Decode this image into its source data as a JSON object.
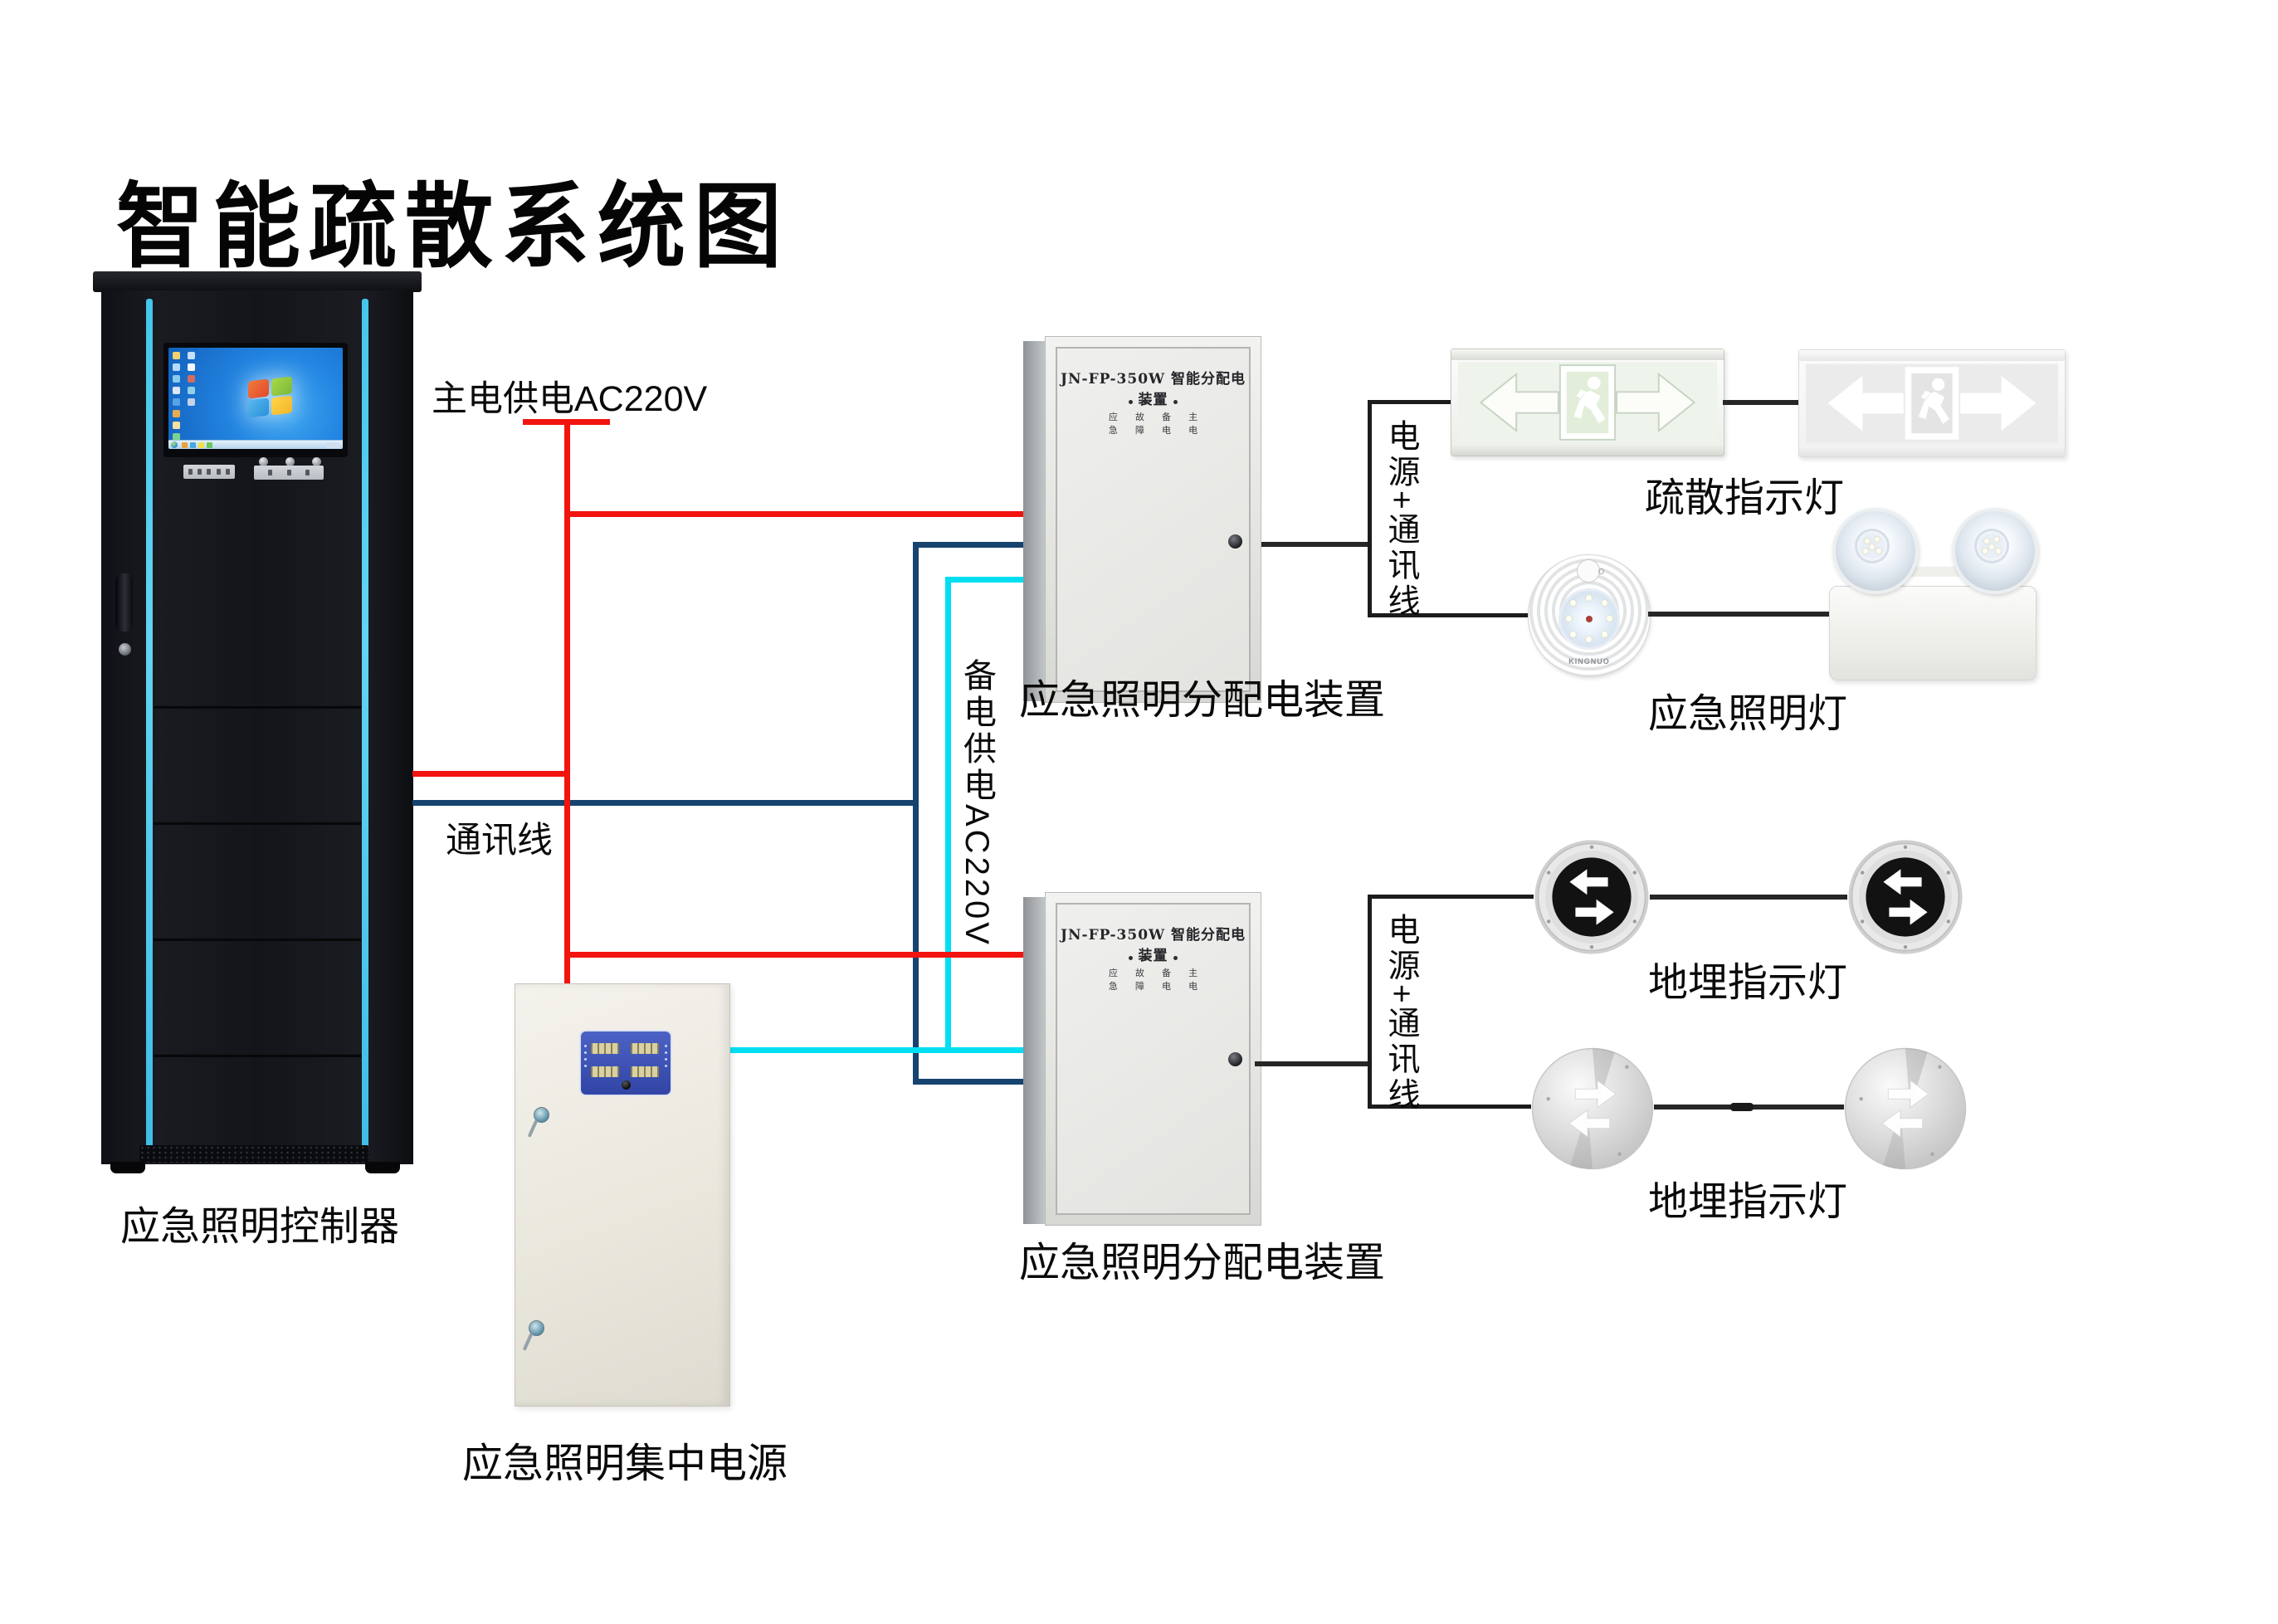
{
  "title": "智能疏散系统图",
  "controller": {
    "label": "应急照明控制器"
  },
  "power_supply": {
    "label": "应急照明集中电源"
  },
  "boxes": {
    "panel_title": "JN-FP-350W 智能分配电装置",
    "indicators_row1": "应 故 备 主",
    "indicators_row2": "急 障 电 电",
    "label": "应急照明分配电装置"
  },
  "wires": {
    "main_power": "主电供电AC220V",
    "comm": "通讯线",
    "backup_power": "备电供电AC220V",
    "bus": "电源+通讯线"
  },
  "devices": {
    "exit_sign_label": "疏散指示灯",
    "emergency_light_label": "应急照明灯",
    "ground_light_label": "地埋指示灯",
    "round_light_brand": "KINGNUO"
  },
  "colors": {
    "main_power_wire": "#f2140f",
    "comm_wire": "#17436f",
    "backup_power_wire": "#00dff2",
    "device_wire": "#262626"
  }
}
